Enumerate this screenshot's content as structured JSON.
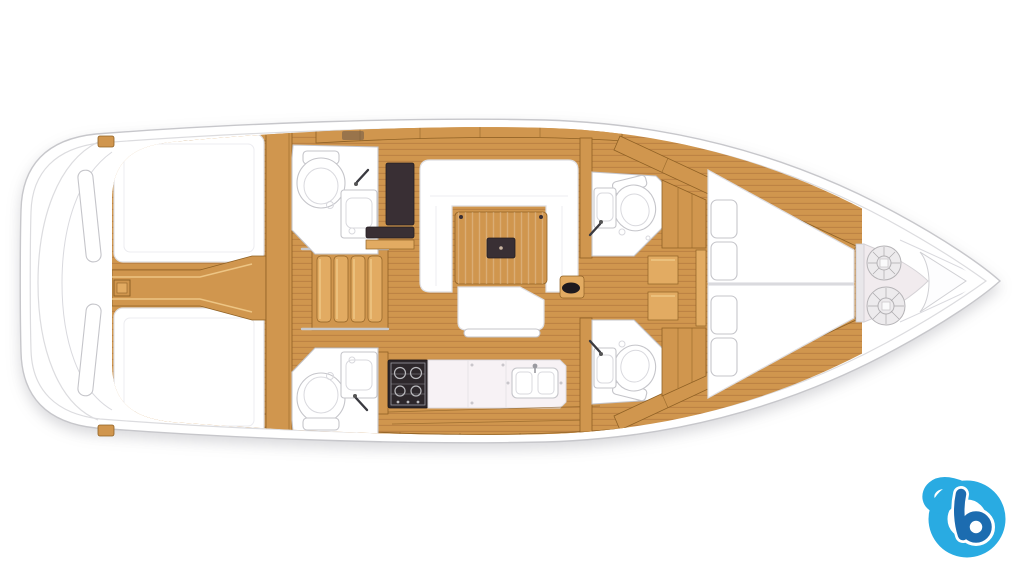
{
  "image": {
    "title": "Sailing yacht interior layout floor plan, top view, bow pointing right",
    "type": "boat-floor-plan"
  },
  "colors": {
    "hullFill": "#ffffff",
    "hullStroke": "#c7c7cb",
    "deckLine": "#dcdcdf",
    "wood": "#d0964e",
    "woodLight": "#e2ab62",
    "woodHi": "#f0ca8b",
    "woodEdge": "#8f6125",
    "plankLine": "#bc8243",
    "darkWood": "#392f34",
    "stoveDark": "#2d272b",
    "counter": "#f7f2f5",
    "lockerFloor": "#f1ebee",
    "white": "#ffffff",
    "furnStroke": "#dedee2",
    "fixStroke": "#c5c5ca",
    "steel": "#c9c9cc",
    "logoLight": "#29abe2",
    "logoDark": "#1c6cb0"
  },
  "components": [
    {
      "id": "hull",
      "label": "hull outline with swim platform stern and pointed bow"
    },
    {
      "id": "transom",
      "label": "stern / cockpit transom curves with twin helm seats"
    },
    {
      "id": "aft-cabin-port",
      "label": "aft double cabin, port (top), white berth"
    },
    {
      "id": "aft-cabin-starboard",
      "label": "aft double cabin, starboard (bottom), white berth"
    },
    {
      "id": "engine-compartment",
      "label": "central engine / keel beam between aft cabins"
    },
    {
      "id": "companionway-steps",
      "label": "companionway stairs, four wooden treads"
    },
    {
      "id": "head-port-mid",
      "label": "bathroom with toilet and sink, port midship"
    },
    {
      "id": "head-starboard-mid",
      "label": "bathroom with toilet and sink, starboard midship"
    },
    {
      "id": "wardrobe",
      "label": "dark wardrobe / locker beside port head"
    },
    {
      "id": "saloon-settee",
      "label": "U-shaped white saloon settee"
    },
    {
      "id": "saloon-table",
      "label": "wooden saloon table with dark center insert"
    },
    {
      "id": "saloon-bench",
      "label": "straight white saloon bench"
    },
    {
      "id": "galley",
      "label": "galley with stove, countertop and double sink"
    },
    {
      "id": "head-port-forward",
      "label": "forward bathroom, port"
    },
    {
      "id": "head-starboard-forward",
      "label": "forward bathroom, starboard"
    },
    {
      "id": "forward-cabin",
      "label": "forward V-berth cabin with four pillows"
    },
    {
      "id": "anchor-locker",
      "label": "bow anchor locker with two rope coils"
    },
    {
      "id": "brand-logo",
      "label": "blue letter-b brand watermark"
    }
  ],
  "logo": {
    "letter": "b"
  }
}
